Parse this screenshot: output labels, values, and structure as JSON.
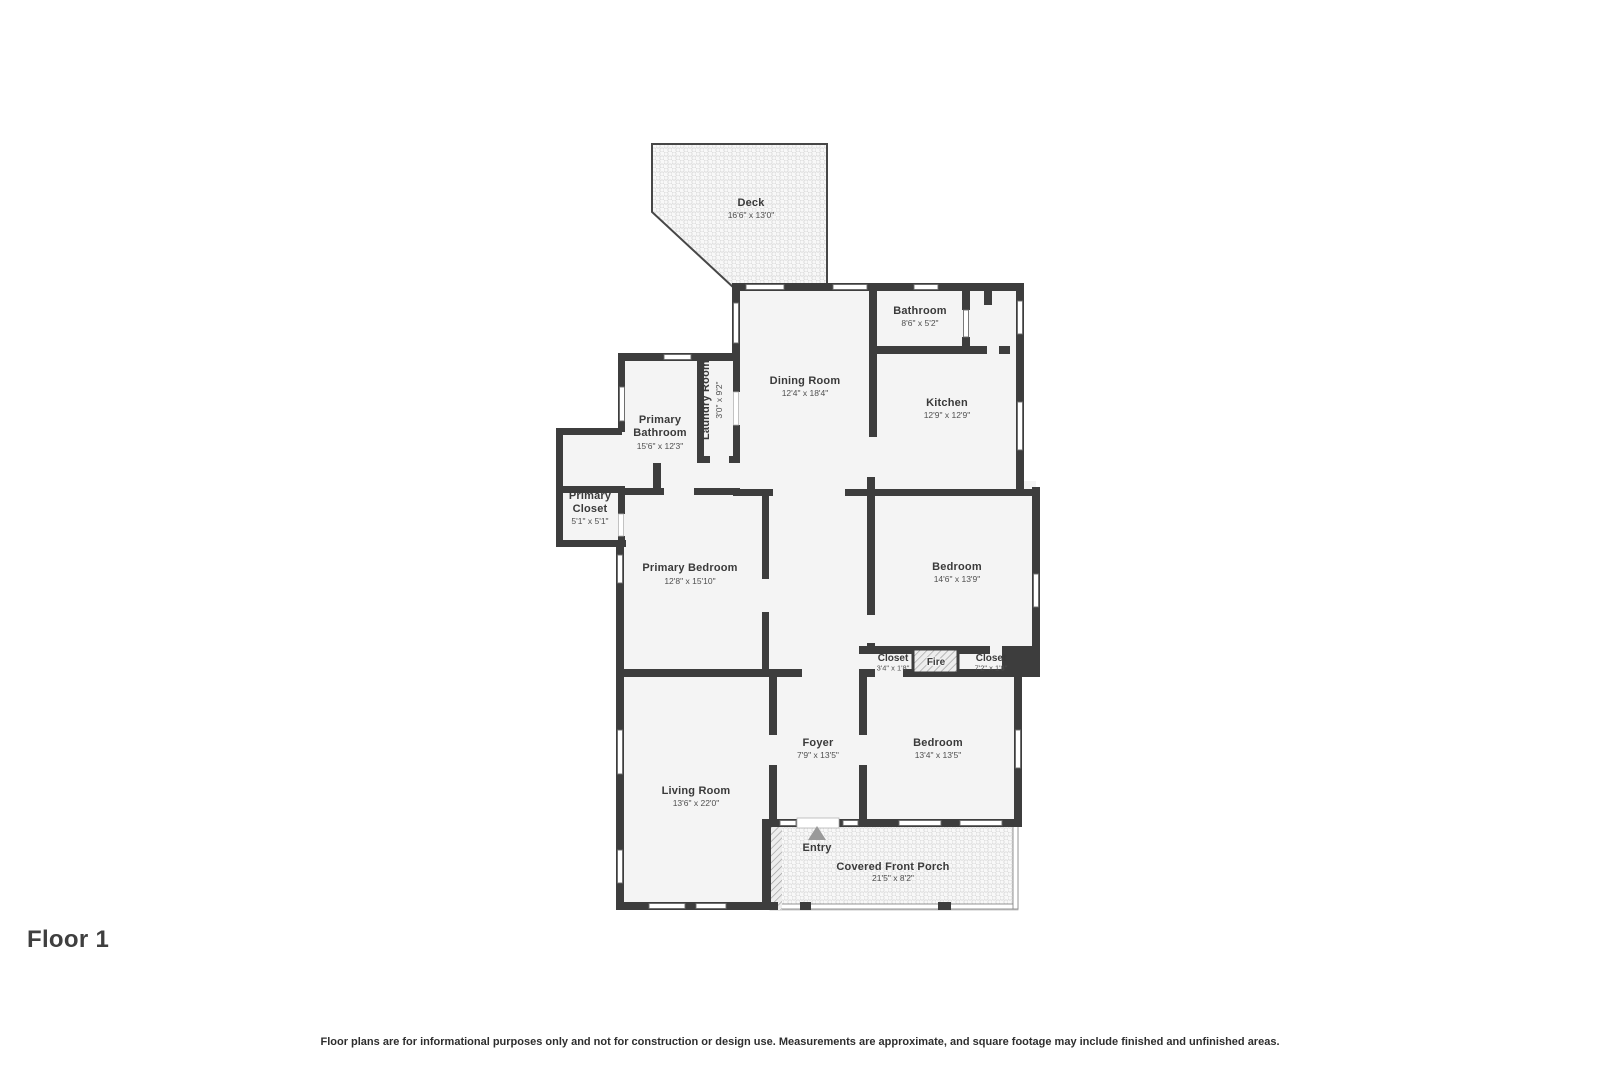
{
  "floor_label": "Floor 1",
  "disclaimer": "Floor plans are for informational purposes only and not for construction or design use. Measurements are approximate, and square footage may include finished and unfinished areas.",
  "colors": {
    "wall": "#3d3d3d",
    "room_fill": "#f4f4f4",
    "pattern_stroke": "#dcdcdc",
    "text": "#3a3a3a",
    "entry_arrow": "#9a9a9a"
  },
  "rooms": {
    "deck": {
      "name": "Deck",
      "dims": "16'6\" x 13'0\""
    },
    "bathroom": {
      "name": "Bathroom",
      "dims": "8'6\" x 5'2\""
    },
    "dining_room": {
      "name": "Dining Room",
      "dims": "12'4\" x 18'4\""
    },
    "kitchen": {
      "name": "Kitchen",
      "dims": "12'9\" x 12'9\""
    },
    "laundry_room": {
      "name": "Laundry Room",
      "dims": "3'0\" x 9'2\""
    },
    "primary_bathroom": {
      "name": "Primary Bathroom",
      "lines": [
        "Primary",
        "Bathroom"
      ],
      "dims": "15'6\" x 12'3\""
    },
    "primary_closet": {
      "name": "Primary Closet",
      "lines": [
        "Primary",
        "Closet"
      ],
      "dims": "5'1\" x 5'1\""
    },
    "primary_bedroom": {
      "name": "Primary Bedroom",
      "dims": "12'8\" x 15'10\""
    },
    "bedroom_1": {
      "name": "Bedroom",
      "dims": "14'6\" x 13'9\""
    },
    "closet_1": {
      "name": "Closet",
      "dims": "3'4\" x 1'8\""
    },
    "fireplace": {
      "name": "Fire"
    },
    "closet_2": {
      "name": "Closet",
      "dims": "7'2\" x 1'8\""
    },
    "foyer": {
      "name": "Foyer",
      "dims": "7'9\" x 13'5\""
    },
    "bedroom_2": {
      "name": "Bedroom",
      "dims": "13'4\" x 13'5\""
    },
    "living_room": {
      "name": "Living Room",
      "dims": "13'6\" x 22'0\""
    },
    "entry": {
      "name": "Entry"
    },
    "covered_front_porch": {
      "name": "Covered Front Porch",
      "dims": "21'5\" x 8'2\""
    }
  }
}
